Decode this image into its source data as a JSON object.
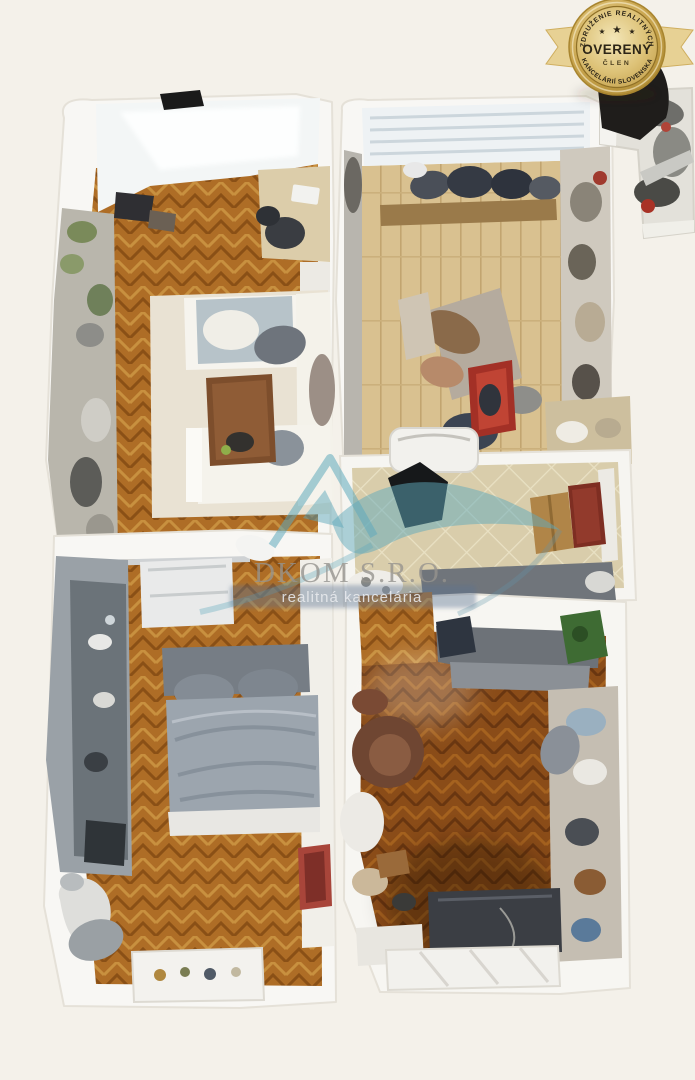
{
  "page": {
    "background_color": "#f4f1ea",
    "description": "3D top-down dollhouse scan of a furnished apartment (real-estate listing photo)"
  },
  "badge": {
    "arc_top": "ZDRUŽENIE REALITNÝCH",
    "arc_bottom": "KANCELÁRIÍ SLOVENSKA",
    "title": "OVERENÝ",
    "subtitle": "ČLEN",
    "stars": [
      "★",
      "★",
      "★"
    ],
    "colors": {
      "gold_light": "#eedfa8",
      "gold": "#c8a550",
      "gold_dark": "#8f7026",
      "text": "#2c2517",
      "ribbon": "#e7d194"
    }
  },
  "watermark": {
    "company": "DKOM S.R.O.",
    "tagline": "realitná kancelária",
    "colors": {
      "logo_teal": "#5faabc",
      "company_text": "#a8a59e",
      "tagline_band": "#5a7391"
    }
  },
  "floorplan": {
    "rooms": [
      {
        "name": "living-room",
        "floor": "herringbone-parquet",
        "floor_color": "#ae6d26",
        "furniture": [
          "window",
          "tv",
          "shelving-plants",
          "desk",
          "office-chair",
          "corner-sofa",
          "coffee-table",
          "rug"
        ]
      },
      {
        "name": "kitchen-dining",
        "floor": "wood-planks",
        "floor_color": "#d9c190",
        "furniture": [
          "window-blinds",
          "bench",
          "shoes",
          "drying-rack",
          "red-jacket",
          "wardrobe"
        ]
      },
      {
        "name": "balcony",
        "floor": "concrete",
        "floor_color": "#e3e1da",
        "furniture": [
          "stored-items"
        ]
      },
      {
        "name": "hallway",
        "floor": "tiles",
        "floor_color": "#d9cdab",
        "furniture": [
          "washing-machine",
          "cardboard-box",
          "entrance-door",
          "dark-object"
        ]
      },
      {
        "name": "bedroom",
        "floor": "herringbone-parquet",
        "floor_color": "#ae6d26",
        "furniture": [
          "kitchenette-cabinets",
          "double-bed",
          "wardrobe",
          "window-sill",
          "red-object",
          "crib"
        ]
      },
      {
        "name": "second-room",
        "floor": "herringbone-parquet",
        "floor_color": "#8a4c18",
        "furniture": [
          "sofa",
          "plant",
          "armchair",
          "desk",
          "shelving"
        ]
      }
    ]
  }
}
